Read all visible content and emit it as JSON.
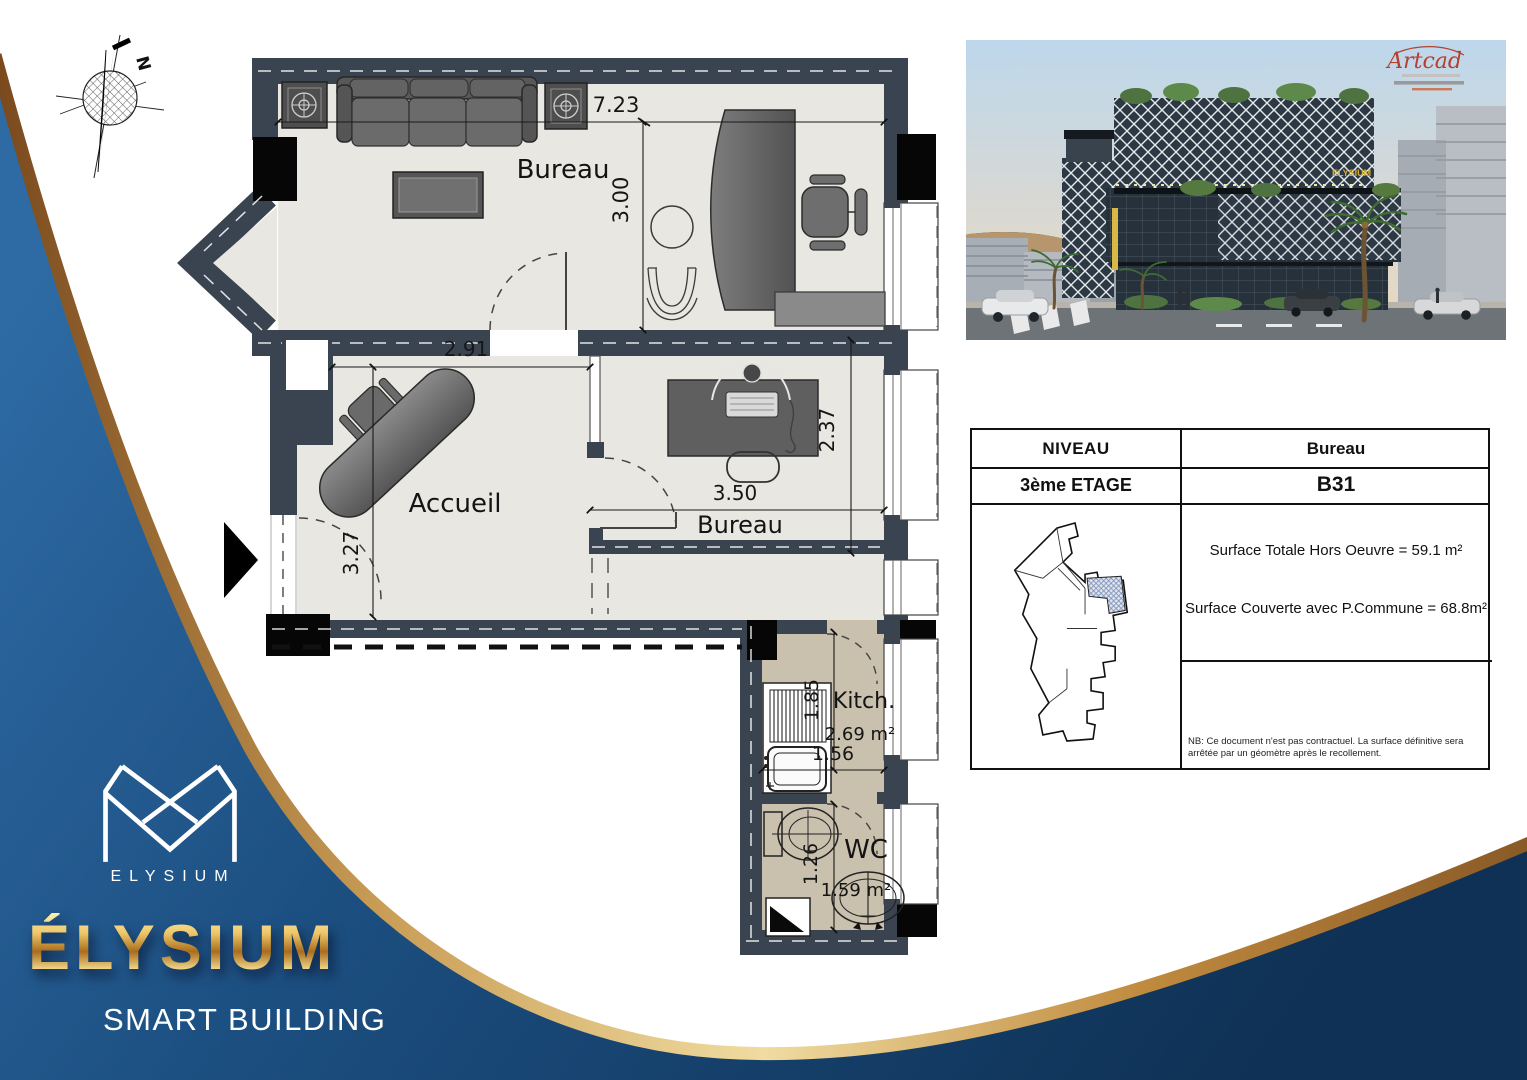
{
  "brand": {
    "monogram_caption": "ELYSIUM",
    "wordmark": "ÉLYSIUM",
    "tagline": "SMART BUILDING"
  },
  "compass": {
    "north_label": "N"
  },
  "photo": {
    "watermark": "Artcad",
    "building_sign": "ELYSIUM"
  },
  "plan": {
    "labels": {
      "bureau_top": "Bureau",
      "accueil": "Accueil",
      "bureau_mid": "Bureau",
      "kitchen": "Kitch.",
      "wc": "WC"
    },
    "areas": {
      "kitchen": "2.69 m²",
      "wc": "1.59 m²"
    },
    "dims": {
      "bureau_top_w": "7.23",
      "bureau_top_d": "3.00",
      "accueil_w": "2.91",
      "accueil_d": "3.27",
      "bureau_mid_w": "3.50",
      "bureau_mid_d": "2.37",
      "kitchen_d": "1.85",
      "kitchen_w": "1.56",
      "wc_d": "1.26"
    }
  },
  "info_table": {
    "level_header": "NIVEAU",
    "type_header": "Bureau",
    "level_value": "3ème ETAGE",
    "unit_value": "B31",
    "surface_line1": "Surface Totale Hors Oeuvre = 59.1 m²",
    "surface_line2": "Surface Couverte avec P.Commune = 68.8m²",
    "note": "NB: Ce document n'est pas contractuel. La surface définitive sera arrêtée par un géomètre après le recollement."
  },
  "colors": {
    "navy": "#1b4d7e",
    "navy_dark": "#0f3155",
    "gold": "#d7b267",
    "wall": "#3a4450",
    "floor": "#e8e7e2",
    "wet_floor": "#c9c0ad",
    "accent_red": "#b5402e"
  }
}
